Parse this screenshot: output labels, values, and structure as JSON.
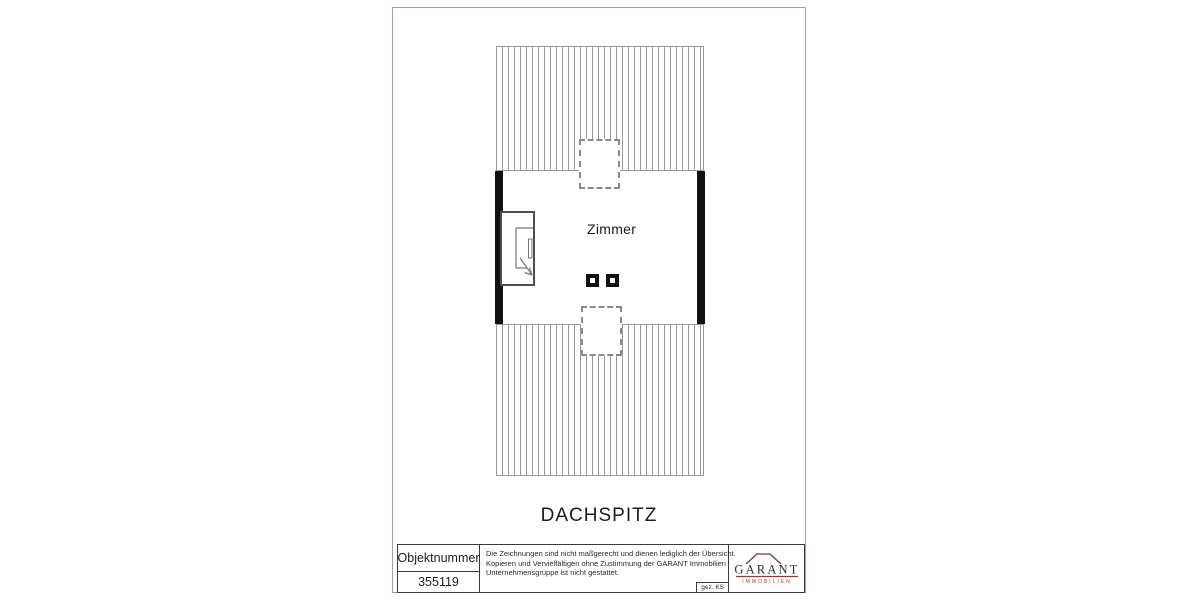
{
  "page": {
    "background_color": "#ffffff",
    "frame_color": "#b59a98"
  },
  "floor_plan": {
    "room_label": "Zimmer",
    "floor_label": "DACHSPITZ",
    "wall_color": "#111111",
    "hatch_line_color": "#9a9a9a",
    "chimney_outline_style": "dashed"
  },
  "title_block": {
    "object_number_label": "Objektnummer",
    "object_number_value": "355119",
    "disclaimer_lines": [
      "Die Zeichnungen sind nicht maßgerecht und dienen lediglich der Übersicht.",
      "Kopieren und Vervielfältigen ohne Zustimmung der GARANT Immobilien",
      "Unternehmensgruppe ist nicht gestattet."
    ],
    "drawn_by": "gez. KS",
    "logo": {
      "name": "GARANT",
      "subtitle": "IMMOBILIEN",
      "text_color": "#232c44",
      "accent_color": "#7b3136"
    }
  }
}
